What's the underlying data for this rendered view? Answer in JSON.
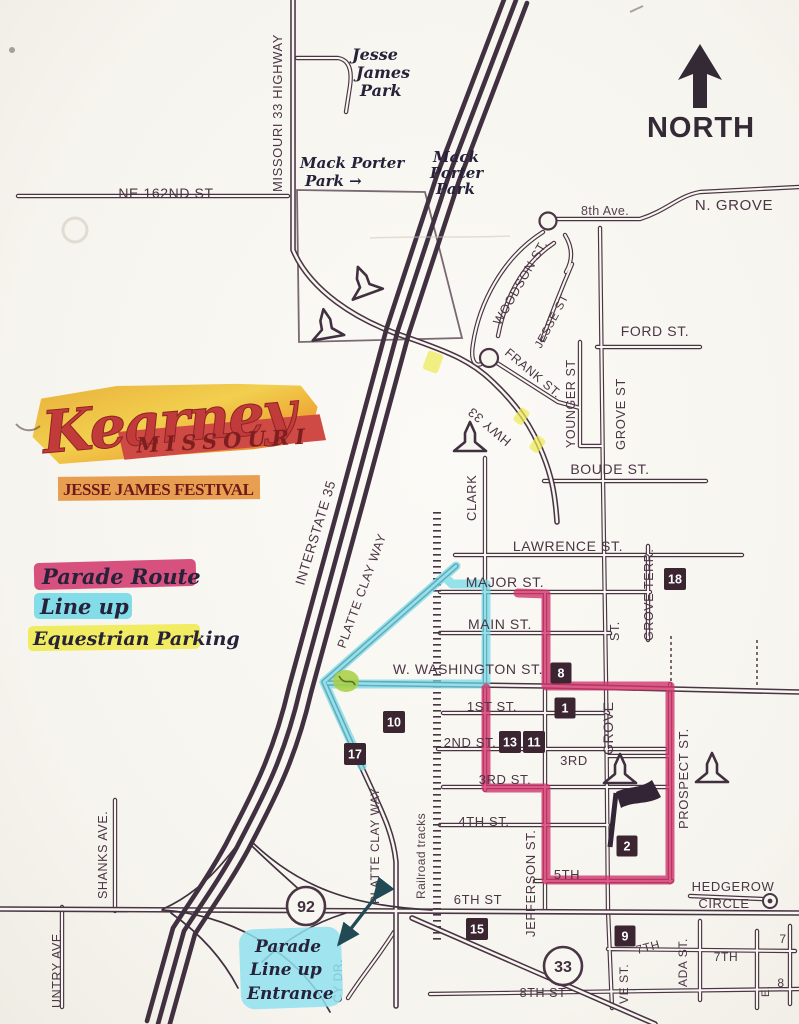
{
  "map": {
    "north_label": "NORTH",
    "logo": {
      "name": "Kearney",
      "state": "MISSOURI",
      "festival": "JESSE JAMES FESTIVAL"
    },
    "legend": {
      "parade_route": "Parade Route",
      "line_up": "Line up",
      "equestrian_parking": "Equestrian Parking"
    },
    "notes": {
      "jesse_james_park": {
        "l1": "Jesse",
        "l2": "James",
        "l3": "Park"
      },
      "mack_porter_west": {
        "l1": "Mack Porter",
        "l2": "Park →"
      },
      "mack_porter_east": {
        "l1": "Mack",
        "l2": "Porter",
        "l3": "Park"
      },
      "entrance": {
        "l1": "Parade",
        "l2": "Line up",
        "l3": "Entrance"
      }
    },
    "highways": {
      "interstate": "INTERSTATE 35",
      "missouri33": "MISSOURI 33 HIGHWAY",
      "hwy33": "HWY 33",
      "shield92": "92",
      "shield33": "33"
    },
    "streets": {
      "ne162": "NE 162ND ST",
      "ave8": "8th Ave.",
      "ngrove": "N. GROVE",
      "woodson": "WOODSON ST.",
      "jesse": "JESSE ST",
      "ford": "FORD ST.",
      "frank": "FRANK ST.",
      "younger": "YOUNGER ST",
      "grove_st_upper": "GROVE ST",
      "grove_st_part": "ST.",
      "boude": "BOUDE ST.",
      "lawrence": "LAWRENCE ST.",
      "clark": "CLARK",
      "grove_terr": "GROVE TERR.",
      "major": "MAJOR ST.",
      "main": "MAIN ST.",
      "washington": "W. WASHINGTON ST.",
      "first": "1ST ST.",
      "second": "2ND ST.",
      "third": "3RD ST.",
      "third_short": "3RD",
      "fourth": "4TH ST.",
      "fifth": "5TH",
      "sixth": "6TH ST",
      "seventh_a": "7TH",
      "seventh_b": "7TH",
      "eighth": "8TH ST",
      "edge_seven": "7",
      "edge_eight": "8",
      "edge_e": "E.",
      "platte_clay_mid": "PLATTE CLAY WAY",
      "platte_clay_south": "PLATTE CLAY WAY",
      "railroad": "Railroad tracks",
      "jefferson": "JEFFERSON ST.",
      "grove_lower": "GROVE",
      "prospect": "PROSPECT ST.",
      "hedgerow_l1": "HEDGEROW",
      "hedgerow_l2": "CIRCLE",
      "shanks": "SHANKS AVE.",
      "untry": "UNTRY AVE.",
      "cy_dr": "CY DR.",
      "ada": "ADA ST.",
      "ve_st": "VE ST."
    },
    "badges": {
      "b1": "1",
      "b2": "2",
      "b8": "8",
      "b9": "9",
      "b10": "10",
      "b11": "11",
      "b13": "13",
      "b15": "15",
      "b17": "17",
      "b18": "18"
    },
    "colors": {
      "paper": "#f8f6f1",
      "ink": "#4a3544",
      "ink_dark": "#342536",
      "parade_route": "#d1346b",
      "line_up": "#6fd8e8",
      "equestrian": "#f0eb52",
      "entrance_highlight": "#8fe0ef",
      "green_mark": "#a9cf40",
      "logo_red": "#c23b3b",
      "logo_dark_red": "#7e1f1f",
      "logo_orange": "#eca433",
      "badge_bg": "#3a2531"
    }
  }
}
